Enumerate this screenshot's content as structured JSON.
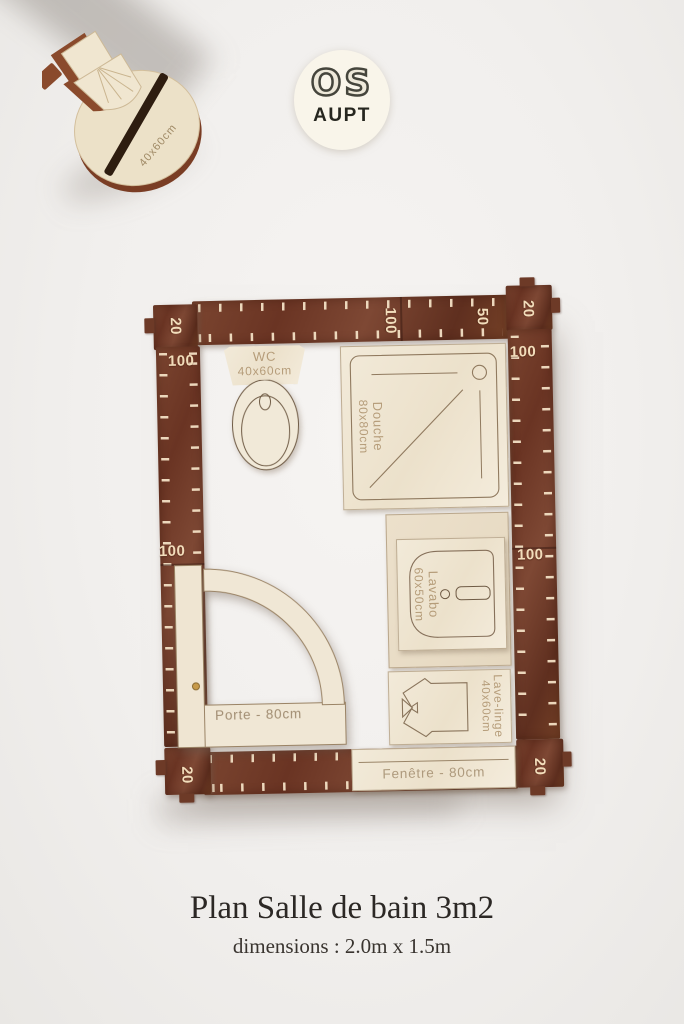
{
  "logo": {
    "top": "OS",
    "bottom": "AUPT"
  },
  "standing_piece": {
    "engraving": "40x60cm"
  },
  "caption": {
    "title": "Plan Salle de bain 3m2",
    "subtitle": "dimensions : 2.0m x 1.5m"
  },
  "rulers": {
    "top_corner_left": "20",
    "top_100": "100",
    "top_50": "50",
    "top_corner_right": "20",
    "left_100_top": "100",
    "left_100_mid": "100",
    "corner_bottom_left": "20",
    "right_100_top": "100",
    "right_100_mid": "100",
    "corner_bottom_right": "20"
  },
  "fixtures": {
    "wc": {
      "name": "WC",
      "size": "40x60cm"
    },
    "douche": {
      "name": "Douche",
      "size": "80x80cm"
    },
    "lavabo": {
      "name": "Lavabo",
      "size": "60x50cm",
      "side_engraving": "60x50cm"
    },
    "lave_linge": {
      "name": "Lave-linge",
      "size": "40x60cm"
    },
    "porte": {
      "label": "Porte - 80cm"
    },
    "fenetre": {
      "label": "Fenêtre - 80cm"
    }
  },
  "colors": {
    "wood_dark": "#6e3826",
    "wood_light": "#f0e7d5",
    "engraving": "#b59c79",
    "ruler_numbers": "#f2ddbb",
    "background": "#f2f0ee",
    "logo_background": "#f9f5ea",
    "title_text": "#2c2825"
  }
}
